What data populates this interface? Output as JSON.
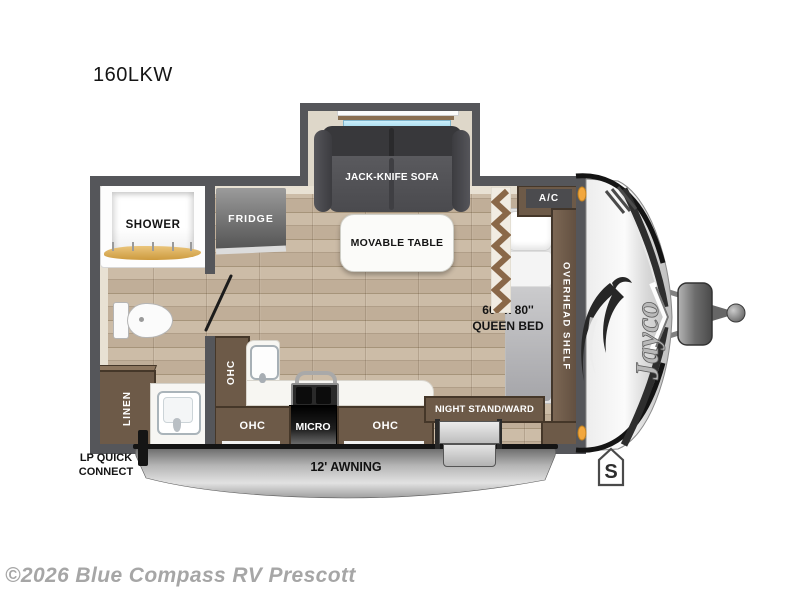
{
  "page": {
    "model_title": "160LKW",
    "watermark": "©2026 Blue Compass RV Prescott"
  },
  "floorplan": {
    "slideout": {
      "sofa_label": "JACK-KNIFE SOFA"
    },
    "bathroom": {
      "shower_label": "SHOWER",
      "linen_label": "LINEN"
    },
    "kitchen": {
      "fridge_label": "FRIDGE",
      "table_label": "MOVABLE TABLE",
      "ohc_upper_label": "OHC",
      "ohc_lower_left_label": "OHC",
      "micro_label": "MICRO",
      "ohc_lower_right_label": "OHC"
    },
    "bedroom": {
      "ac_label": "A/C",
      "overhead_shelf_label": "OVERHEAD SHELF",
      "bed_size_label": "60'' x 80''",
      "bed_type_label": "QUEEN BED",
      "night_stand_label": "NIGHT STAND/WARD"
    },
    "exterior": {
      "awning_label": "12' AWNING",
      "lp_line1": "LP QUICK",
      "lp_line2": "CONNECT",
      "brand_logo": "Jayco",
      "badge_letter": "S"
    },
    "colors": {
      "wall": "#55565a",
      "floor": "#c3b19b",
      "cabinet": "#6d5a48",
      "counter": "#f7f6f2",
      "sofa": "#4a4a4e",
      "window_glass": "#9fd6ec",
      "shower_curtain": "#d9a751",
      "marker_light": "#f0a83c",
      "awning": "#b9b9b9"
    }
  }
}
